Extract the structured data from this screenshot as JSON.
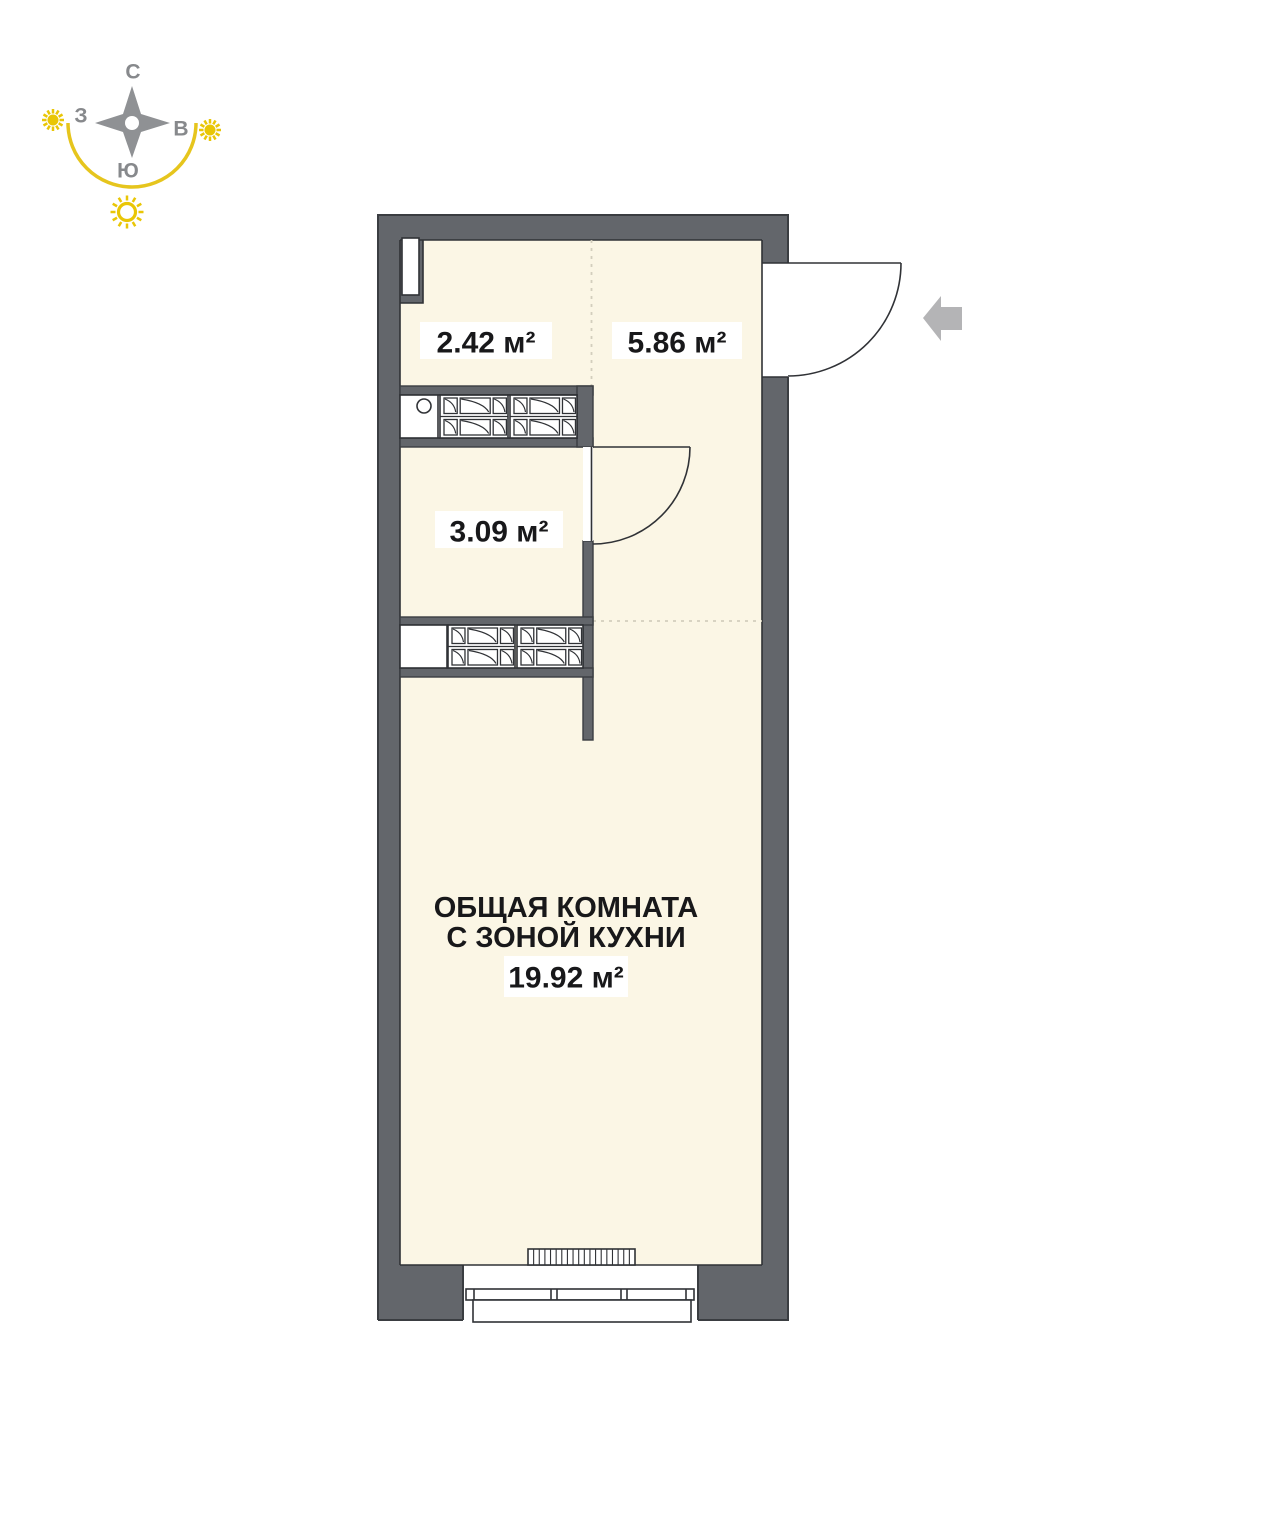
{
  "compass": {
    "north_label": "С",
    "east_label": "В",
    "south_label": "Ю",
    "west_label": "З"
  },
  "plan": {
    "hall_closet_area": "2.42 м²",
    "hallway_area": "5.86 м²",
    "bathroom_area": "3.09 м²",
    "main_room": {
      "name_line1": "ОБЩАЯ КОМНАТА",
      "name_line2": "С ЗОНОЙ КУХНИ",
      "area": "19.92 м²"
    }
  },
  "colors": {
    "wall": "#63666b",
    "floor": "#fbf6e5",
    "accent_yellow": "#e9c606",
    "arc_yellow": "#e6c51d",
    "compass_gray": "#8f9194",
    "arrow_gray": "#b4b4b6"
  }
}
